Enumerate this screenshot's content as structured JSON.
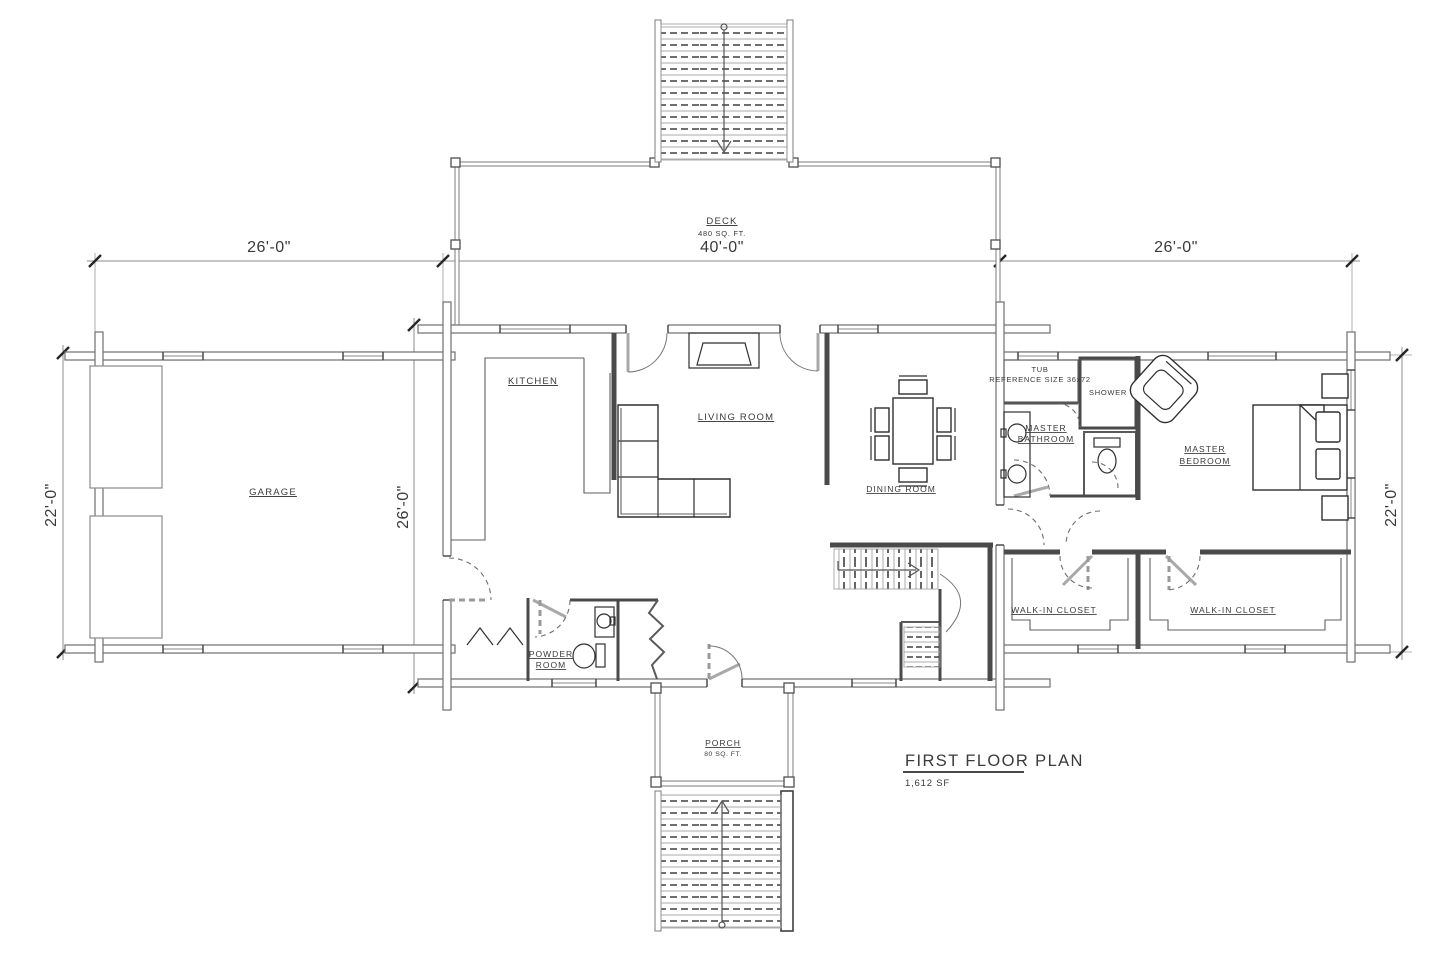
{
  "drawing": {
    "title": "FIRST FLOOR PLAN",
    "total_area": "1,612 SF"
  },
  "rooms": {
    "deck": {
      "name": "DECK",
      "area": "480 SQ. FT."
    },
    "porch": {
      "name": "PORCH",
      "area": "80 SQ. FT."
    },
    "garage": {
      "name": "GARAGE"
    },
    "kitchen": {
      "name": "KITCHEN"
    },
    "living_room": {
      "name": "LIVING ROOM"
    },
    "dining_room": {
      "name": "DINING ROOM"
    },
    "powder_room": {
      "line1": "POWDER",
      "line2": "ROOM"
    },
    "master_bathroom": {
      "line1": "MASTER",
      "line2": "BATHROOM"
    },
    "master_bedroom": {
      "line1": "MASTER",
      "line2": "BEDROOM"
    },
    "shower": {
      "name": "SHOWER"
    },
    "tub": {
      "line1": "TUB",
      "line2": "REFERENCE SIZE 36x72"
    },
    "walk_in_closet_left": {
      "name": "WALK-IN CLOSET"
    },
    "walk_in_closet_right": {
      "name": "WALK-IN CLOSET"
    }
  },
  "dimensions": {
    "top_left": "26'-0\"",
    "top_center": "40'-0\"",
    "top_right": "26'-0\"",
    "left": "22'-0\"",
    "center": "26'-0\"",
    "right": "22'-0\""
  },
  "colors": {
    "background": "#ffffff",
    "wall_line": "#6f6f6f",
    "detail_line": "#2f2f2f",
    "dimension_line": "#8c8c8c",
    "text": "#3a3a3a"
  }
}
